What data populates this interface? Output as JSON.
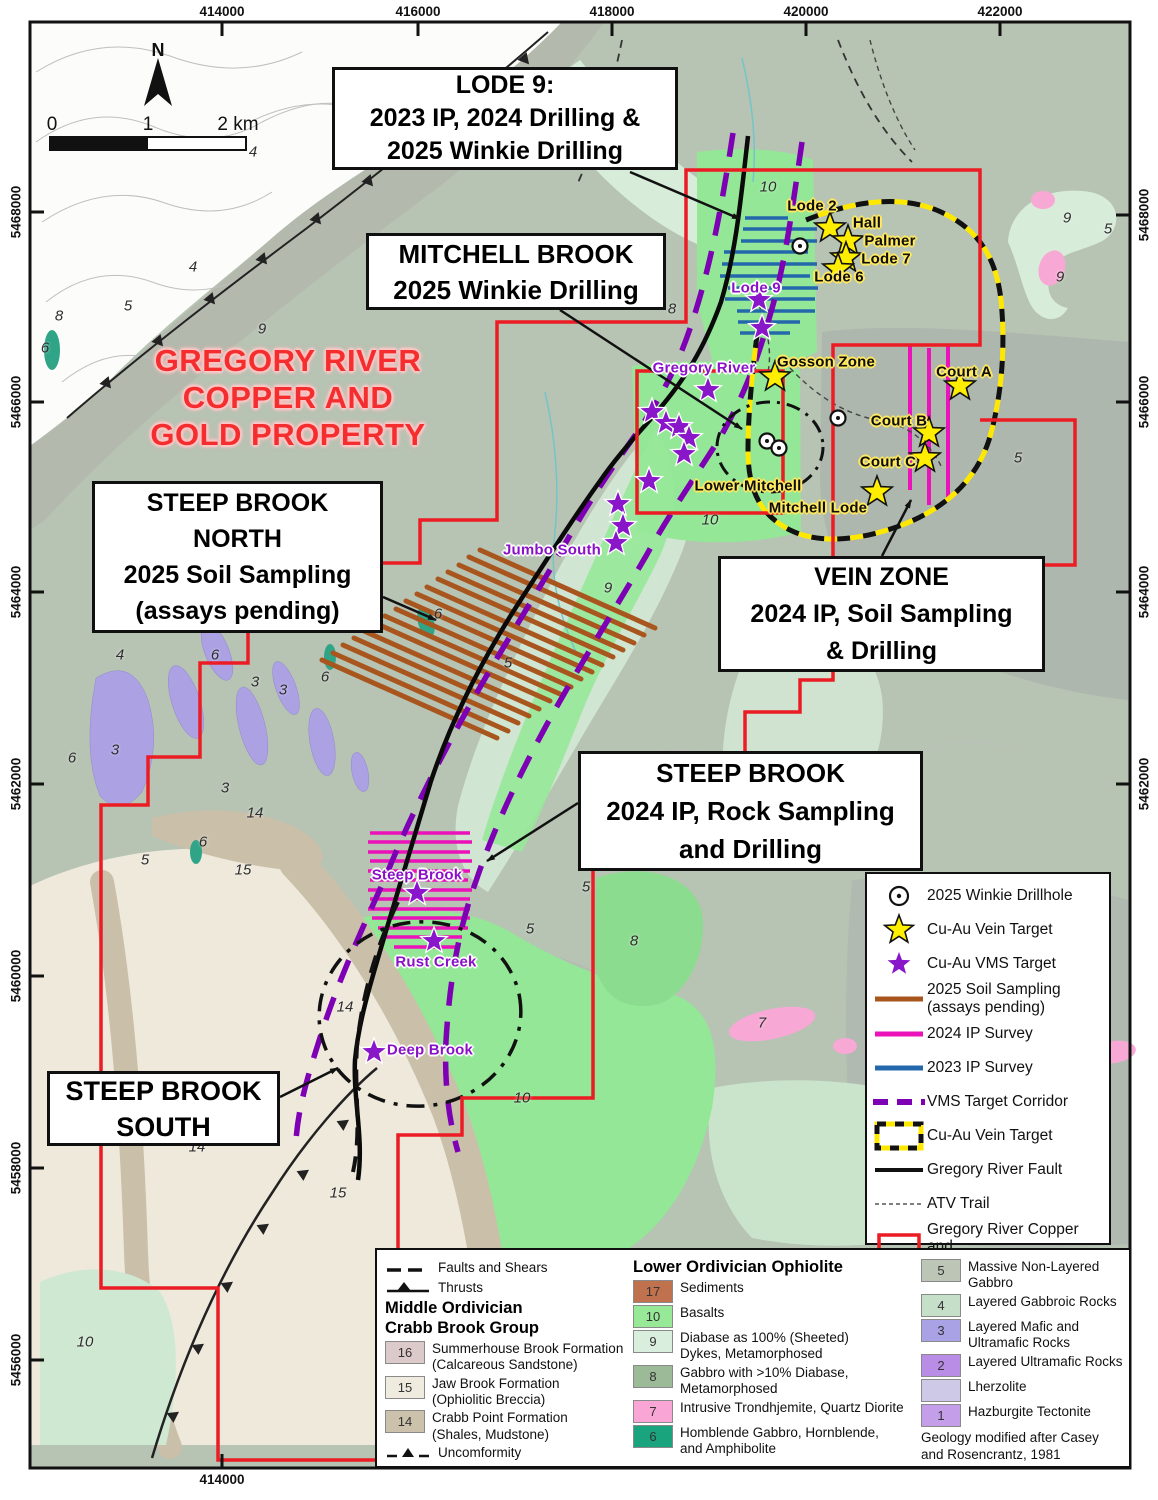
{
  "page_title": "Gregory River Copper and Gold Property Map",
  "north_label": "N",
  "scale_bar": {
    "tick0": "0",
    "tick1": "1",
    "tick2": "2 km"
  },
  "property_title": {
    "lines": [
      "GREGORY RIVER",
      "COPPER AND",
      "GOLD PROPERTY"
    ]
  },
  "coordinates": {
    "top": [
      {
        "label": "414000",
        "x": 222
      },
      {
        "label": "416000",
        "x": 418
      },
      {
        "label": "418000",
        "x": 612
      },
      {
        "label": "420000",
        "x": 806
      },
      {
        "label": "422000",
        "x": 1000
      }
    ],
    "bottom": [
      {
        "label": "414000",
        "x": 222
      }
    ],
    "left": [
      {
        "label": "5468000",
        "y": 212
      },
      {
        "label": "5466000",
        "y": 402
      },
      {
        "label": "5464000",
        "y": 592
      },
      {
        "label": "5462000",
        "y": 784
      },
      {
        "label": "5460000",
        "y": 976
      },
      {
        "label": "5458000",
        "y": 1168
      },
      {
        "label": "5456000",
        "y": 1360
      }
    ],
    "right": [
      {
        "label": "5468000",
        "y": 215
      },
      {
        "label": "5466000",
        "y": 402
      },
      {
        "label": "5464000",
        "y": 592
      },
      {
        "label": "5462000",
        "y": 784
      }
    ]
  },
  "callouts": {
    "lode9": {
      "lines": [
        "LODE 9:",
        "2023 IP, 2024 Drilling &",
        "2025 Winkie Drilling"
      ]
    },
    "mitchell_brook": {
      "lines": [
        "MITCHELL BROOK",
        "2025 Winkie Drilling"
      ]
    },
    "steep_brook_north": {
      "lines": [
        "STEEP BROOK",
        "NORTH",
        "2025 Soil Sampling",
        "(assays pending)"
      ]
    },
    "vein_zone": {
      "lines": [
        "VEIN ZONE",
        "2024 IP, Soil Sampling",
        "& Drilling"
      ]
    },
    "steep_brook": {
      "lines": [
        "STEEP BROOK",
        "2024 IP, Rock Sampling",
        "and Drilling"
      ]
    },
    "steep_brook_south": {
      "lines": [
        "STEEP BROOK",
        "SOUTH"
      ]
    }
  },
  "map_labels": [
    {
      "text": "Lode 2",
      "x": 812,
      "y": 206,
      "style": "y"
    },
    {
      "text": "Hall",
      "x": 867,
      "y": 223,
      "style": "y"
    },
    {
      "text": "Palmer",
      "x": 890,
      "y": 241,
      "style": "y"
    },
    {
      "text": "Lode 7",
      "x": 886,
      "y": 259,
      "style": "y"
    },
    {
      "text": "Lode 6",
      "x": 839,
      "y": 277,
      "style": "y"
    },
    {
      "text": "Lode 9",
      "x": 756,
      "y": 288,
      "style": "p"
    },
    {
      "text": "Gregory River",
      "x": 704,
      "y": 368,
      "style": "p"
    },
    {
      "text": "Gosson Zone",
      "x": 826,
      "y": 362,
      "style": "y"
    },
    {
      "text": "Court A",
      "x": 964,
      "y": 372,
      "style": "y"
    },
    {
      "text": "Court B",
      "x": 899,
      "y": 421,
      "style": "y"
    },
    {
      "text": "Court C",
      "x": 888,
      "y": 462,
      "style": "y"
    },
    {
      "text": "Lower Mitchell",
      "x": 748,
      "y": 486,
      "style": "y"
    },
    {
      "text": "Mitchell Lode",
      "x": 818,
      "y": 508,
      "style": "y"
    },
    {
      "text": "Jumbo South",
      "x": 552,
      "y": 550,
      "style": "p"
    },
    {
      "text": "Steep Brook",
      "x": 417,
      "y": 875,
      "style": "p"
    },
    {
      "text": "Rust Creek",
      "x": 436,
      "y": 962,
      "style": "p"
    },
    {
      "text": "Deep Brook",
      "x": 430,
      "y": 1050,
      "style": "p"
    }
  ],
  "unit_numbers": [
    [
      253,
      152,
      "4"
    ],
    [
      193,
      267,
      "4"
    ],
    [
      128,
      306,
      "5"
    ],
    [
      59,
      316,
      "8"
    ],
    [
      45,
      348,
      "6"
    ],
    [
      262,
      329,
      "9"
    ],
    [
      768,
      187,
      "10"
    ],
    [
      672,
      309,
      "8"
    ],
    [
      1067,
      218,
      "9"
    ],
    [
      1060,
      277,
      "9"
    ],
    [
      1108,
      229,
      "5"
    ],
    [
      710,
      520,
      "10"
    ],
    [
      608,
      588,
      "9"
    ],
    [
      508,
      663,
      "5"
    ],
    [
      438,
      614,
      "6"
    ],
    [
      120,
      655,
      "4"
    ],
    [
      215,
      655,
      "6"
    ],
    [
      255,
      682,
      "3"
    ],
    [
      283,
      690,
      "3"
    ],
    [
      325,
      677,
      "6"
    ],
    [
      115,
      750,
      "3"
    ],
    [
      72,
      758,
      "6"
    ],
    [
      225,
      788,
      "3"
    ],
    [
      255,
      813,
      "14"
    ],
    [
      203,
      842,
      "6"
    ],
    [
      145,
      860,
      "5"
    ],
    [
      243,
      870,
      "15"
    ],
    [
      345,
      1007,
      "14"
    ],
    [
      530,
      929,
      "5"
    ],
    [
      586,
      887,
      "5"
    ],
    [
      634,
      941,
      "8"
    ],
    [
      762,
      1023,
      "7"
    ],
    [
      522,
      1098,
      "10"
    ],
    [
      197,
      1147,
      "14"
    ],
    [
      338,
      1193,
      "15"
    ],
    [
      85,
      1342,
      "10"
    ],
    [
      1018,
      458,
      "5"
    ]
  ],
  "map_symbols": {
    "vms_stars": [
      [
        759,
        300
      ],
      [
        762,
        328
      ],
      [
        708,
        390
      ],
      [
        652,
        412
      ],
      [
        666,
        423
      ],
      [
        679,
        427
      ],
      [
        689,
        438
      ],
      [
        684,
        454
      ],
      [
        649,
        481
      ],
      [
        618,
        504
      ],
      [
        623,
        526
      ],
      [
        616,
        543
      ],
      [
        417,
        893
      ],
      [
        434,
        941
      ],
      [
        374,
        1052
      ]
    ],
    "vein_stars": [
      [
        830,
        228
      ],
      [
        848,
        241
      ],
      [
        846,
        258
      ],
      [
        838,
        269
      ],
      [
        775,
        377
      ],
      [
        960,
        386
      ],
      [
        929,
        433
      ],
      [
        925,
        458
      ],
      [
        877,
        492
      ]
    ],
    "winkie_holes": [
      [
        800,
        246
      ],
      [
        838,
        418
      ],
      [
        767,
        441
      ],
      [
        779,
        448
      ]
    ],
    "ip2023_lines": [
      [
        745,
        788,
        218
      ],
      [
        743,
        817,
        229
      ],
      [
        741,
        817,
        241
      ],
      [
        724,
        808,
        252
      ],
      [
        722,
        817,
        264
      ],
      [
        720,
        810,
        276
      ],
      [
        728,
        818,
        288
      ],
      [
        725,
        815,
        299
      ],
      [
        737,
        815,
        311
      ],
      [
        738,
        800,
        322
      ],
      [
        740,
        790,
        333
      ]
    ],
    "ip2024_steep_lines": [
      [
        370,
        470,
        833
      ],
      [
        368,
        472,
        842
      ],
      [
        368,
        470,
        852
      ],
      [
        370,
        472,
        861
      ],
      [
        368,
        470,
        871
      ],
      [
        370,
        468,
        880
      ],
      [
        368,
        472,
        890
      ],
      [
        370,
        470,
        899
      ],
      [
        368,
        470,
        909
      ],
      [
        372,
        470,
        918
      ],
      [
        378,
        468,
        928
      ],
      [
        386,
        462,
        937
      ],
      [
        394,
        456,
        947
      ]
    ],
    "ip2024_court_lines": [
      [
        910,
        345,
        490
      ],
      [
        929,
        348,
        505
      ],
      [
        948,
        345,
        498
      ]
    ],
    "soil_lines": [
      [
        480,
        550,
        655,
        628
      ],
      [
        469,
        557,
        644,
        635
      ],
      [
        459,
        565,
        634,
        643
      ],
      [
        448,
        572,
        623,
        650
      ],
      [
        438,
        579,
        613,
        657
      ],
      [
        427,
        587,
        602,
        665
      ],
      [
        417,
        594,
        592,
        672
      ],
      [
        406,
        601,
        581,
        679
      ],
      [
        396,
        609,
        571,
        687
      ],
      [
        385,
        616,
        560,
        694
      ],
      [
        375,
        623,
        550,
        701
      ],
      [
        364,
        631,
        539,
        709
      ],
      [
        354,
        638,
        529,
        716
      ],
      [
        343,
        645,
        518,
        723
      ],
      [
        333,
        653,
        508,
        731
      ],
      [
        322,
        660,
        497,
        738
      ]
    ]
  },
  "colors": {
    "property_red": "#ec1c24",
    "vms_purple": "#7d00b5",
    "vein_yellow": "#ffe800",
    "ip2024_magenta": "#ea12b8",
    "ip2023_blue": "#2468ac",
    "soil_brown": "#a8561e",
    "star_purple": "#8a16c9",
    "star_yellow": "#ffee00"
  },
  "legend": {
    "items": [
      {
        "symbol": "winkie",
        "lines": [
          "2025 Winkie Drillhole"
        ]
      },
      {
        "symbol": "vein-star",
        "lines": [
          "Cu-Au Vein Target"
        ]
      },
      {
        "symbol": "vms-star",
        "lines": [
          "Cu-Au VMS Target"
        ]
      },
      {
        "symbol": "soil-line",
        "lines": [
          "2025 Soil Sampling",
          "(assays pending)"
        ]
      },
      {
        "symbol": "ip2024",
        "lines": [
          "2024 IP Survey"
        ]
      },
      {
        "symbol": "ip2023",
        "lines": [
          "2023 IP Survey"
        ]
      },
      {
        "symbol": "corridor",
        "lines": [
          "VMS Target Corridor"
        ]
      },
      {
        "symbol": "vein-box",
        "lines": [
          "Cu-Au Vein Target"
        ]
      },
      {
        "symbol": "fault",
        "lines": [
          "Gregory River Fault"
        ]
      },
      {
        "symbol": "atv",
        "lines": [
          "ATV Trail"
        ]
      },
      {
        "symbol": "property",
        "lines": [
          "Gregory River Copper and",
          "Gold Property"
        ]
      }
    ]
  },
  "geology_legend": {
    "faults_shears_label": "Faults and Shears",
    "thrusts_label": "Thrusts",
    "crabb_title_lines": [
      "Middle Ordivician",
      "Crabb Brook Group"
    ],
    "crabb_units": [
      {
        "num": "16",
        "color": "#dcc9c9",
        "lines": [
          "Summerhouse Brook Formation",
          "(Calcareous Sandstone)"
        ]
      },
      {
        "num": "15",
        "color": "#f0ebdf",
        "lines": [
          "Jaw Brook Formation",
          "(Ophiolitic Breccia)"
        ]
      },
      {
        "num": "14",
        "color": "#ccc2ac",
        "lines": [
          "Crabb Point Formation",
          "(Shales, Mudstone)"
        ]
      }
    ],
    "unconformity_label": "Uncomformity",
    "ophiolite_title": "Lower Ordivician Ophiolite",
    "ophiolite_units": [
      {
        "num": "17",
        "color": "#c0714d",
        "lines": [
          "Sediments"
        ]
      },
      {
        "num": "10",
        "color": "#97e897",
        "lines": [
          "Basalts"
        ]
      },
      {
        "num": "9",
        "color": "#daeedd",
        "lines": [
          "Diabase as 100% (Sheeted)",
          "Dykes, Metamorphosed"
        ]
      },
      {
        "num": "8",
        "color": "#9cba97",
        "lines": [
          "Gabbro with >10% Diabase,",
          "Metamorphosed"
        ]
      },
      {
        "num": "7",
        "color": "#f9a6d6",
        "lines": [
          "Intrusive Trondhjemite, Quartz Diorite"
        ]
      },
      {
        "num": "6",
        "color": "#19a47e",
        "lines": [
          "Homblende Gabbro, Hornblende,",
          "and Amphibolite"
        ]
      }
    ],
    "mafic_units": [
      {
        "num": "5",
        "color": "#bcc5b6",
        "lines": [
          "Massive Non-Layered",
          "Gabbro"
        ]
      },
      {
        "num": "4",
        "color": "#c6dfc9",
        "lines": [
          "Layered Gabbroic Rocks"
        ]
      },
      {
        "num": "3",
        "color": "#a9a2e5",
        "lines": [
          "Layered Mafic and",
          "Ultramafic Rocks"
        ]
      },
      {
        "num": "2",
        "color": "#b98de5",
        "lines": [
          "Layered Ultramafic Rocks"
        ]
      },
      {
        "num": "",
        "color": "#cdc9e6",
        "lines": [
          "Lherzolite"
        ]
      },
      {
        "num": "1",
        "color": "#c49ee9",
        "lines": [
          "Hazburgite Tectonite"
        ]
      }
    ],
    "credit_lines": [
      "Geology modified after Casey",
      "and Rosencrantz, 1981"
    ]
  }
}
